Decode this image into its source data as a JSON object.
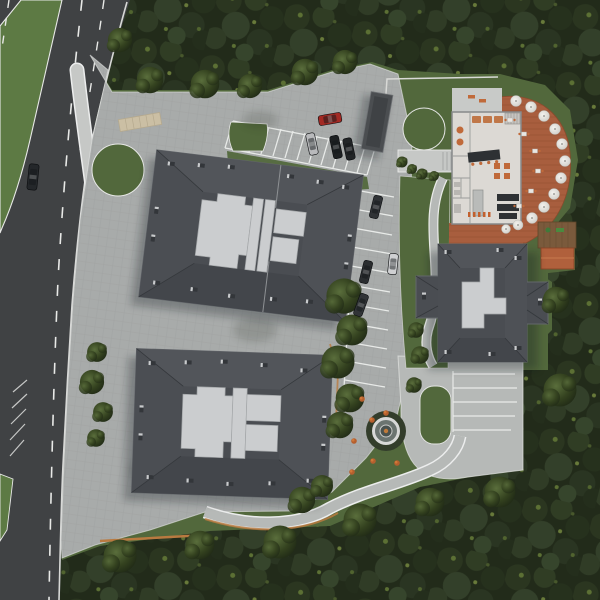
{
  "scene": {
    "kind": "aerial-site-plan-render",
    "description": "Top-down 3D architectural render: residential complex with two large hip-roofed apartment buildings, a cross-shaped third building, a restaurant pavilion with open terracotta terrace, parking rows with cars, fountain garden, curved access road with grass median, all surrounded by dense forest.",
    "palette": {
      "forest_base": "#222b1a",
      "forest_mid": "#2f3c26",
      "grass": "#52683c",
      "median_grass": "#5d7a44",
      "asphalt": "#404244",
      "lane_marking": "#e8e9e7",
      "sidewalk": "#c6c8c6",
      "plaza_pavers": "#a8abaa",
      "concrete_drive": "#b6b9b7",
      "roof_dark": "#4a4d52",
      "roof_flat_light": "#cbcdcf",
      "terrace_terracotta": "#a85e3e",
      "terracotta_roof": "#b0603c",
      "restaurant_floor": "#dcd9d4",
      "furniture_orange": "#c06a3a",
      "kitchen_dark": "#2e3134",
      "fence_tan": "#b97a40",
      "deck_brown": "#7a5a3c",
      "umbrella_white": "#e8e7e3",
      "fountain_ring": "#d8d9d8",
      "speed_table_tan": "#cbbfa4"
    },
    "features": {
      "building_north": "large apartment building, dark hipped roof, light flat roof core",
      "building_south": "large apartment building, dark hipped roof, light flat roof core",
      "building_east": "cross-shaped building, dark hipped roof",
      "restaurant": "open-roof restaurant floor plan with terracotta terrace and umbrellas",
      "pavilion": "small terracotta-roof pavilion with wooden deck and playground",
      "canopy": "dark covered walkway structure at site entrance",
      "fountain": "round fountain in garden with orange shrubs",
      "road": "two-carriageway road with green median, dashed lane markings, merge hatching"
    },
    "fountain": {
      "x": 386,
      "y": 431
    },
    "cars": [
      {
        "label": "car-on-road",
        "color": "#24272a",
        "x": 33,
        "y": 177,
        "rot": 96,
        "len": 26,
        "wid": 10
      },
      {
        "label": "red-car",
        "color": "#a32a24",
        "x": 330,
        "y": 119,
        "rot": -10,
        "len": 23,
        "wid": 10
      },
      {
        "label": "silver-car-parked",
        "color": "#b9babc",
        "x": 312,
        "y": 144,
        "rot": 78,
        "len": 22,
        "wid": 9
      },
      {
        "label": "black-car-parked-1",
        "color": "#1d2022",
        "x": 336,
        "y": 147,
        "rot": 78,
        "len": 23,
        "wid": 9
      },
      {
        "label": "black-car-parked-2",
        "color": "#222527",
        "x": 349,
        "y": 149,
        "rot": 78,
        "len": 22,
        "wid": 9
      },
      {
        "label": "dark-car-parked-3",
        "color": "#303336",
        "x": 376,
        "y": 207,
        "rot": 104,
        "len": 23,
        "wid": 9
      },
      {
        "label": "dark-car-parked-4",
        "color": "#2a2d2f",
        "x": 366,
        "y": 272,
        "rot": 104,
        "len": 23,
        "wid": 9
      },
      {
        "label": "dark-car-parked-5",
        "color": "#313437",
        "x": 361,
        "y": 305,
        "rot": 110,
        "len": 23,
        "wid": 9
      },
      {
        "label": "white-car-driving",
        "color": "#cfd0d2",
        "x": 393,
        "y": 264,
        "rot": 96,
        "len": 21,
        "wid": 9
      }
    ],
    "umbrellas": [
      {
        "x": 516,
        "y": 101,
        "r": 5.5
      },
      {
        "x": 531,
        "y": 107,
        "r": 5.5
      },
      {
        "x": 544,
        "y": 116,
        "r": 5.5
      },
      {
        "x": 555,
        "y": 129,
        "r": 5.5
      },
      {
        "x": 562,
        "y": 144,
        "r": 5.5
      },
      {
        "x": 565,
        "y": 161,
        "r": 5.5
      },
      {
        "x": 561,
        "y": 178,
        "r": 5.5
      },
      {
        "x": 554,
        "y": 194,
        "r": 5.5
      },
      {
        "x": 544,
        "y": 207,
        "r": 5.5
      },
      {
        "x": 532,
        "y": 218,
        "r": 5.5
      },
      {
        "x": 518,
        "y": 225,
        "r": 5.0
      },
      {
        "x": 506,
        "y": 229,
        "r": 4.5
      }
    ],
    "terrace_tables": [
      {
        "x": 524,
        "y": 134
      },
      {
        "x": 535,
        "y": 151
      },
      {
        "x": 538,
        "y": 171
      },
      {
        "x": 531,
        "y": 191
      },
      {
        "x": 519,
        "y": 206
      },
      {
        "x": 510,
        "y": 120
      }
    ],
    "orange_shrubs": [
      {
        "x": 362,
        "y": 399
      },
      {
        "x": 372,
        "y": 420
      },
      {
        "x": 354,
        "y": 441
      },
      {
        "x": 373,
        "y": 461
      },
      {
        "x": 397,
        "y": 463
      },
      {
        "x": 352,
        "y": 472
      },
      {
        "x": 386,
        "y": 413
      }
    ],
    "counts": {
      "buildings": 4,
      "cars": 9,
      "umbrellas": 12,
      "parking_rows": 3
    }
  }
}
